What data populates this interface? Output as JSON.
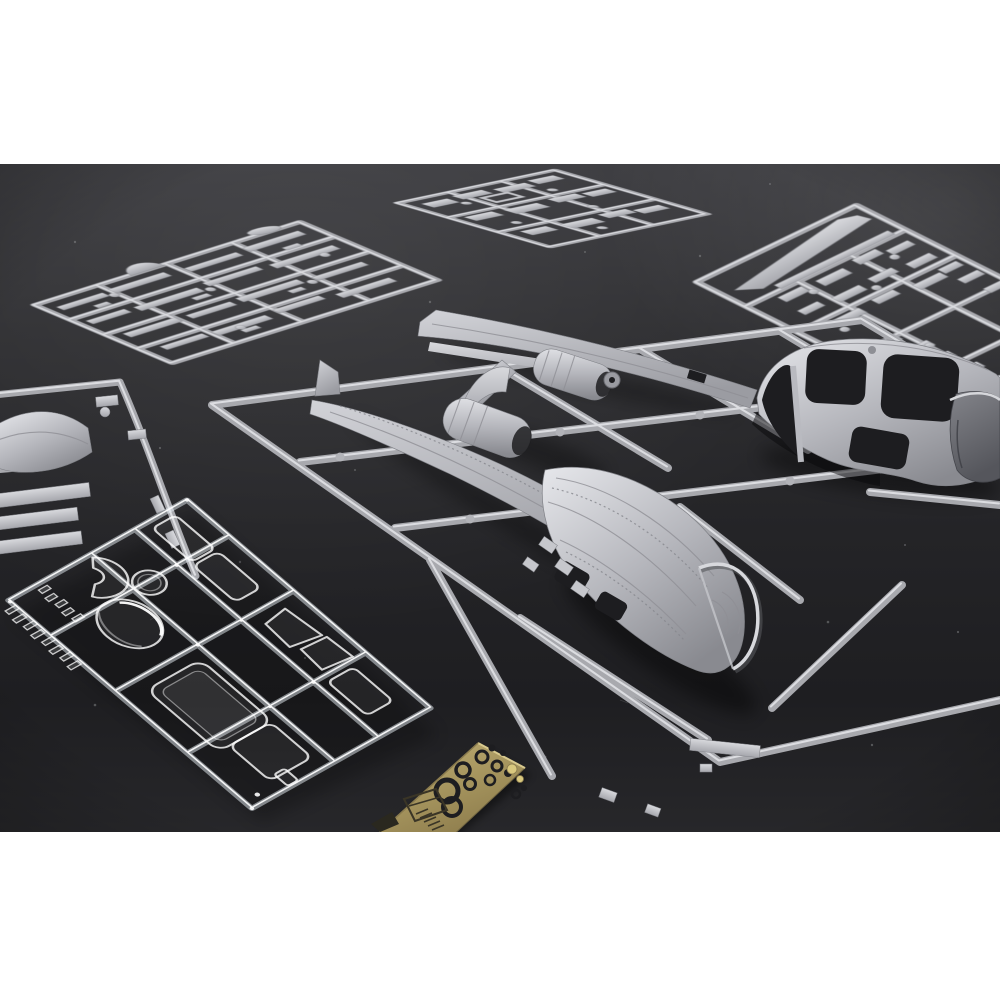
{
  "image": {
    "subject": "Unassembled plastic scale-model aircraft kit sprues laid out on a dark grey surface",
    "style": "angled product photograph with white letterbox bands at top and bottom",
    "aircraft_hint": "twin-boom observation aircraft fuselage pod halves with cockpit window openings"
  },
  "colors": {
    "backdrop_white": "#ffffff",
    "surface_dark": "#242427",
    "plastic_grey": "#a8a9ae",
    "plastic_highlight": "#dcdde1",
    "plastic_shadow": "#63646a",
    "clear_plastic": "#eef3f7",
    "brass": "#a3925c",
    "brass_highlight": "#c9b97f",
    "brass_shadow": "#756844",
    "dark_opening": "#1d1d20"
  },
  "sprues": [
    {
      "id": "A",
      "label": "Small parts sprue, top left, grey styrene"
    },
    {
      "id": "B",
      "label": "Small parts sprue, top middle, grey styrene"
    },
    {
      "id": "C",
      "label": "Wing blade and small parts sprue, top right, grey styrene"
    },
    {
      "id": "D",
      "label": "Partial sprue at left edge with cowling and strip parts, grey styrene"
    },
    {
      "id": "E",
      "label": "Main sprue with fuselage pod halves, tail boom, fin and engine nacelles, grey styrene"
    },
    {
      "id": "F",
      "label": "Clear parts sprue with canopy dome, windscreen and window panes"
    },
    {
      "id": "G",
      "label": "Photo-etched brass detail fret with rings and instrument cutouts"
    }
  ]
}
